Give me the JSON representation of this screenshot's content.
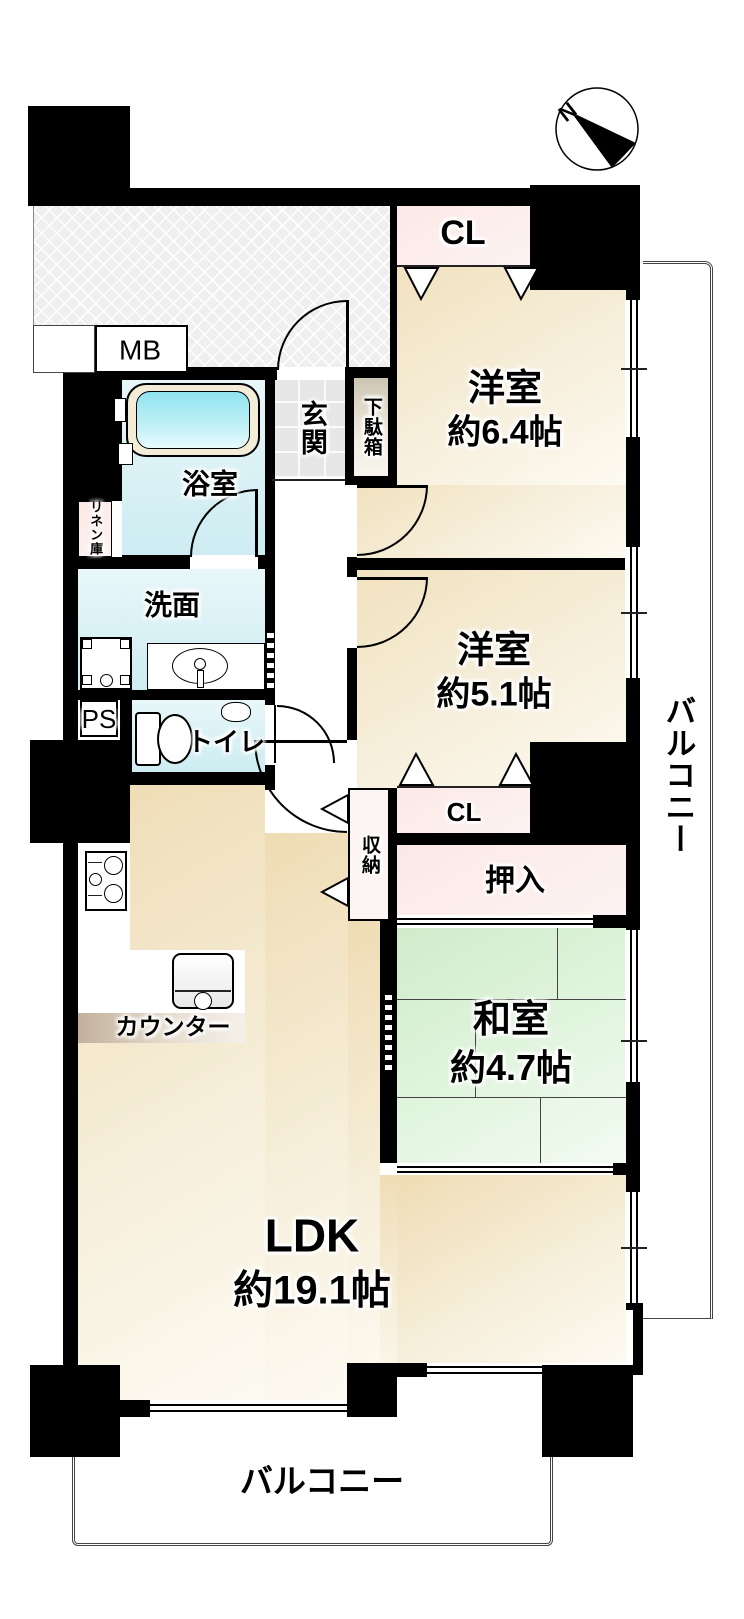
{
  "compass": {
    "north_label": "N"
  },
  "rooms": {
    "ldk": {
      "name": "LDK",
      "area": "約19.1帖"
    },
    "western_room_1": {
      "name": "洋室",
      "area": "約6.4帖"
    },
    "western_room_2": {
      "name": "洋室",
      "area": "約5.1帖"
    },
    "japanese_room": {
      "name": "和室",
      "area": "約4.7帖"
    }
  },
  "spaces": {
    "entrance": "玄関",
    "shoe_cabinet": "下駄箱",
    "bathroom": "浴室",
    "washroom": "洗面",
    "toilet": "トイレ",
    "linen_closet": "リネン庫",
    "storage": "収納",
    "futon_closet": "押入",
    "closet_top": "CL",
    "closet_mid": "CL",
    "meter_box": "MB",
    "pipe_space": "PS",
    "counter": "カウンター",
    "balcony_right": "バルコニー",
    "balcony_bottom": "バルコニー"
  },
  "colors": {
    "wall": "#000000",
    "western_floor": "#f5ead2",
    "tatami_floor": "#d8efd2",
    "closet_pink": "#fdeeec",
    "wet_area": "#d9f1f5",
    "counter_tan": "#c9b9a5",
    "hatch_gray": "#efefef",
    "outline": "#444444"
  }
}
